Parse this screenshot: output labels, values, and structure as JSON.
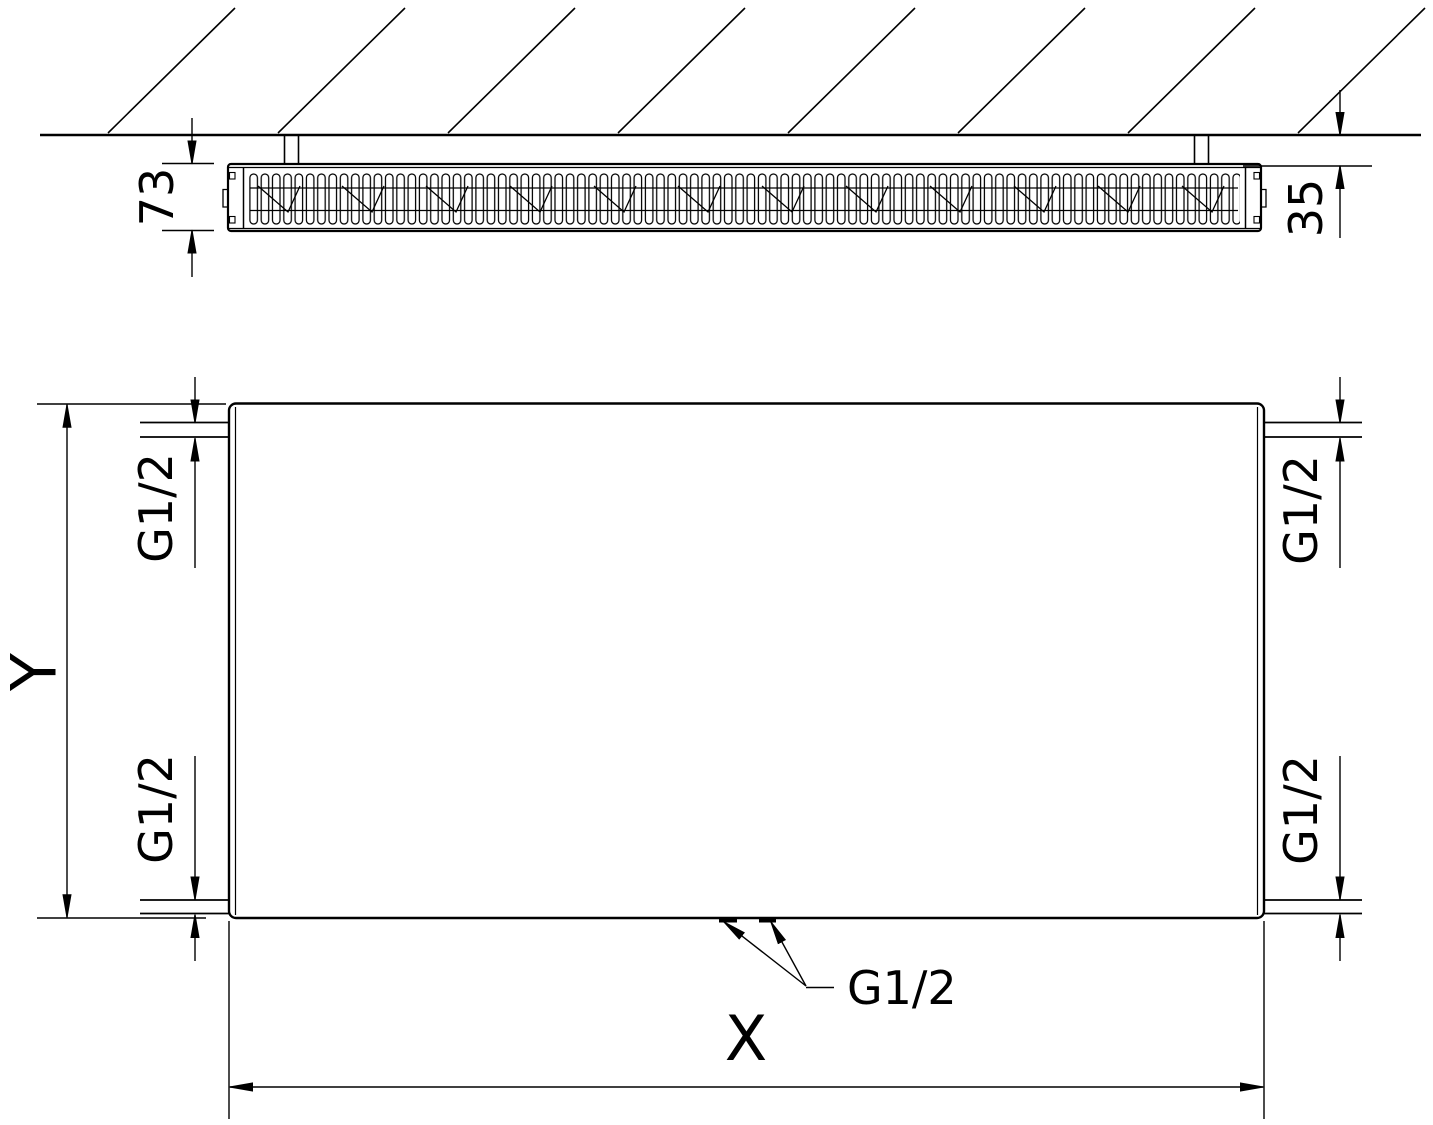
{
  "labels": {
    "depth": "73",
    "wall_distance": "35",
    "height": "Y",
    "width": "X",
    "connection_top_left": "G1/2",
    "connection_bottom_left": "G1/2",
    "connection_top_right": "G1/2",
    "connection_bottom_right": "G1/2",
    "connection_bottom_center": "G1/2"
  },
  "colors": {
    "line": "#000000",
    "background": "#ffffff"
  }
}
